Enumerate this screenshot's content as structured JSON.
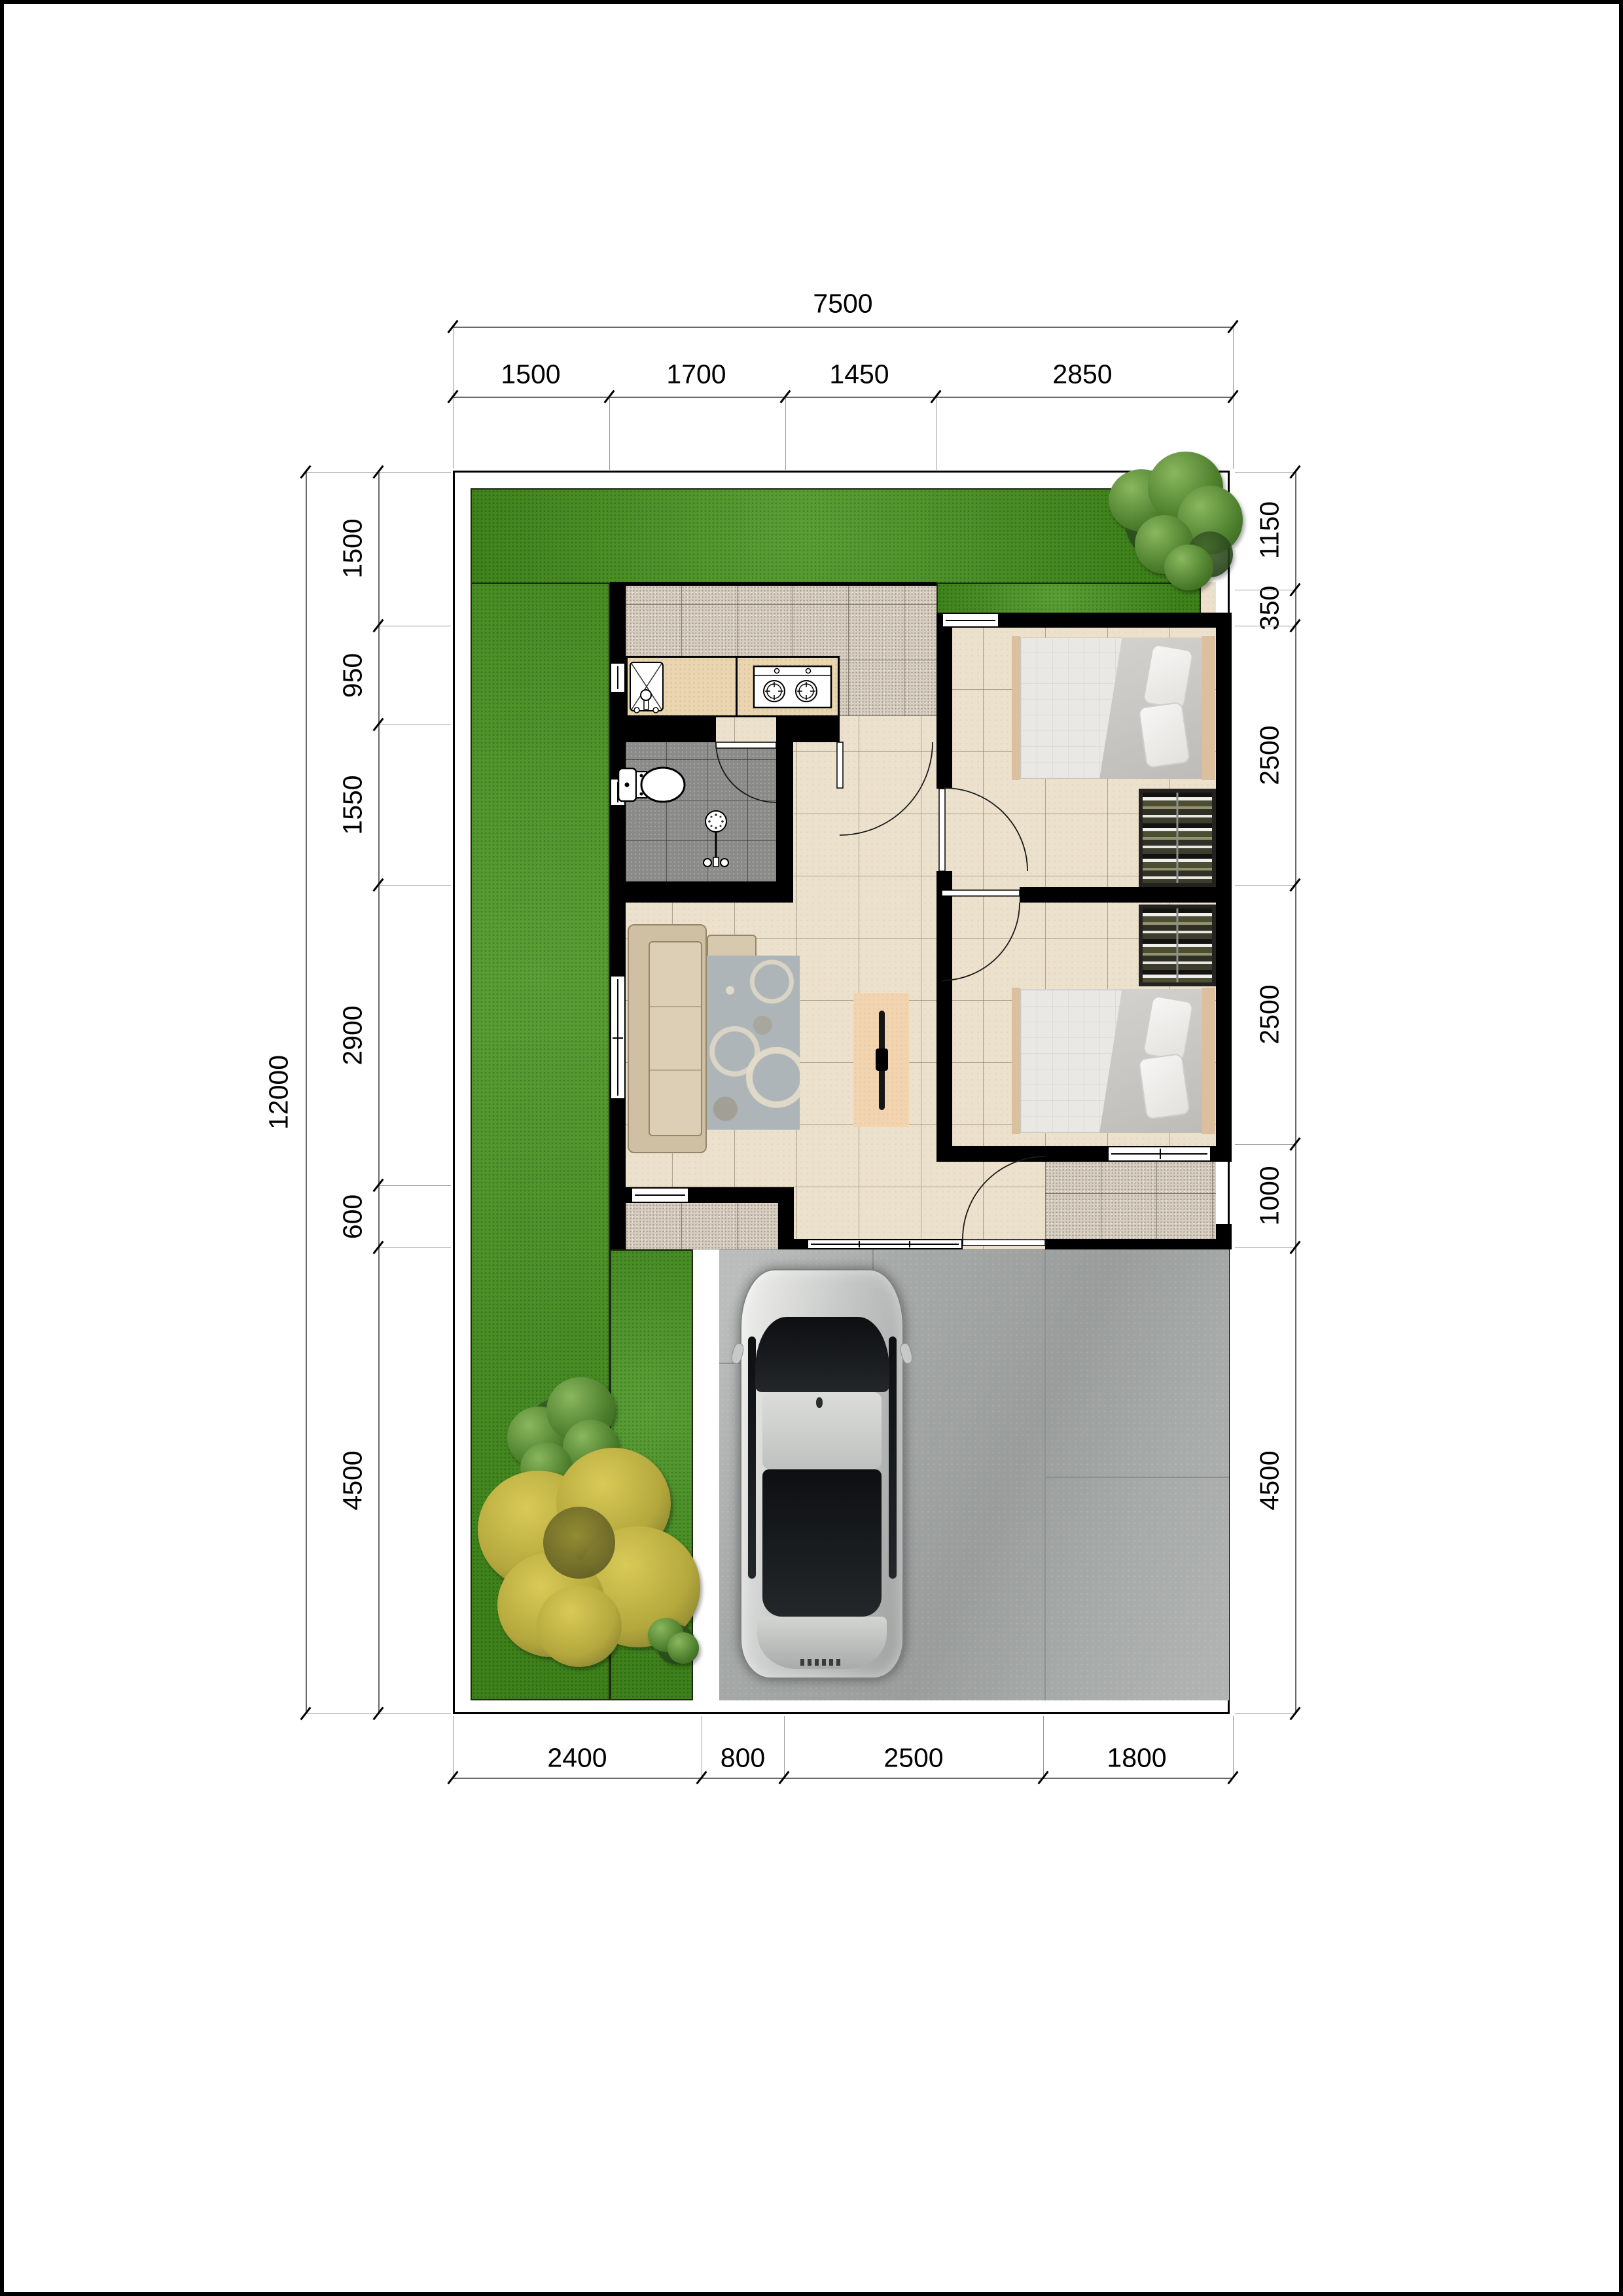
{
  "dimensions": {
    "top_total": "7500",
    "top_segments": [
      "1500",
      "1700",
      "1450",
      "2850"
    ],
    "left_total": "12000",
    "left_segments": [
      "1500",
      "950",
      "1550",
      "2900",
      "600",
      "4500"
    ],
    "right_segments": [
      "1150",
      "350",
      "2500",
      "2500",
      "1000",
      "4500"
    ],
    "bottom_segments": [
      "2400",
      "800",
      "2500",
      "1800"
    ]
  },
  "colors": {
    "grass": "#47931f",
    "wall": "#000000",
    "floor_beige": "#ece1cc",
    "floor_speckle": "#d7cec0",
    "floor_bath": "#8b8b89",
    "carport": "#a6aaa9",
    "counter": "#e9d6b0",
    "sofa": "#cfc0a4",
    "rug": "#adb5b8",
    "bed_duvet": "#e9e8e4",
    "headboard": "#dcc09e",
    "wardrobe": "#23221e",
    "tv_console": "#f2d5b0",
    "car_silver": "#c6c8c7",
    "glass": "#131518",
    "dim_text": "#000000"
  }
}
